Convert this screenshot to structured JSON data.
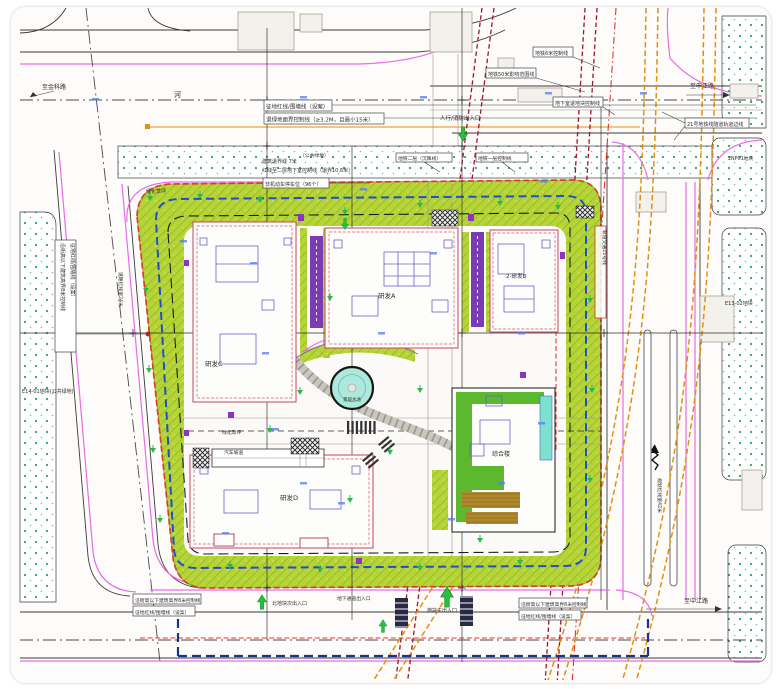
{
  "plan": {
    "road_labels": {
      "to_jinke_road": "至金科路",
      "river": "河",
      "to_shenjiang_road": "至申江路",
      "to_zhongjiang_road": "至中江路",
      "planned_row_42": "规划红线宽42米",
      "planned_row_24": "道路红线宽24米"
    },
    "parcel_labels": {
      "e14_01": "E14-01地块(公共绿地)",
      "e13_02": "E13-02地块",
      "np01": "2NP01地块",
      "public_green": "（公共绿地）"
    },
    "building_labels": {
      "rd_a": "研发A",
      "rd_b": "2-研发B",
      "rd_c": "研发C",
      "rd_d": "研发D",
      "complex": "综合楼"
    },
    "site_labels": {
      "pool": "景观水池",
      "lawn_north": "绿化草坪",
      "lawn_south": "绿化草坪",
      "car_ramp": "汽车坡道"
    },
    "annotations": {
      "red_line_top": "征地红线/围墙线（设案）",
      "green_setback": "退绿地面界控制线（≥3.2M，且最小15米）",
      "metro_6m": "地铁6米控制线",
      "metro_50m": "地铁50米影响范围线",
      "basement_setback": "地下室退地块控制线",
      "metro_21_track": "21号地铁线隧道轨道边线",
      "ped_fire_entry": "人行/消防出入口",
      "setback_7m": "建筑退界线 7米",
      "basement_l2_setback": "红线至二层地下室控制线（退界10.6米）",
      "bike_parking": "非机动车停车位（96个）",
      "metro_l2": "地铁二层（沉降线）",
      "metro_l1": "地铁一层控制线",
      "height_8m_west": "沿街高以下建筑高界8米控制线",
      "red_line_west": "征地红线/围墙线（设案）",
      "height_8m_south_left": "沿街高以下建筑高界8米控制线",
      "red_line_south_left": "征地红线/围墙线（设案）",
      "height_8m_south_right": "沿街高以下建筑高界8米控制线",
      "red_line_south_right": "征地红线/围墙线（设案）",
      "north_sub_entry": "北地块次出入口",
      "main_entry": "地块主出入口",
      "underpass": "地下通道出入口",
      "metro21_corridor": "轨道交通21号线"
    },
    "colors": {
      "red_line": "#e03a2f",
      "dark_red_metro": "#a0122d",
      "orange_metro": "#e2900f",
      "basement_blue": "#2050c8",
      "underpass_navy": "#16338e",
      "road_magenta": "#e86ce4",
      "lawn_green": "#b5d438",
      "dot_green": "#2f9e6e",
      "tree_green": "#2db84c",
      "arrow_green": "#27c23d",
      "pool_teal": "#ace9dc",
      "ramp_purple": "#7a3bb5",
      "deck_brown": "#b0892e",
      "roof_green": "#5cb82f"
    }
  }
}
